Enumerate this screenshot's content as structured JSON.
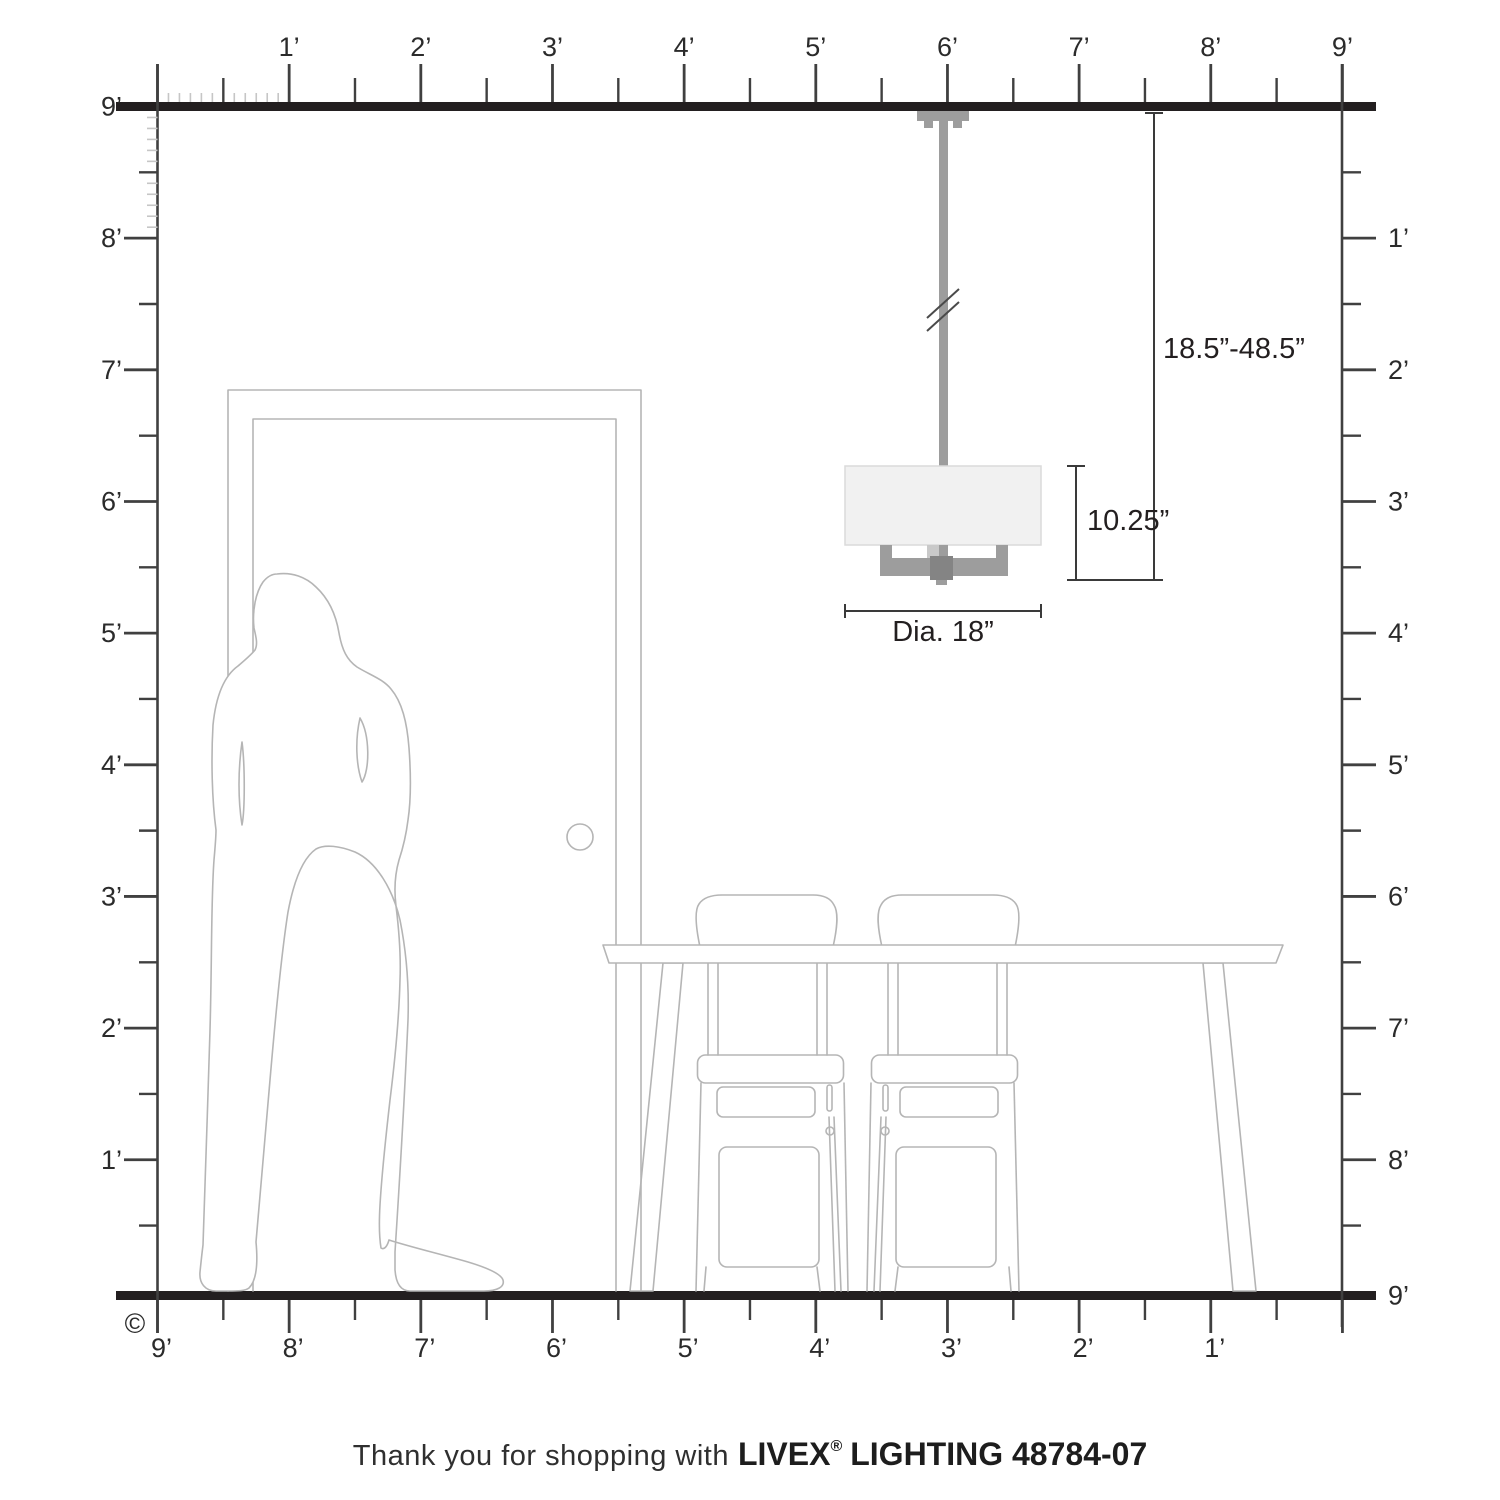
{
  "caption": {
    "prefix": "Thank you for shopping with",
    "brand": "LIVEX",
    "registered": "®",
    "suffix": "LIGHTING 48784-07"
  },
  "dimensions": {
    "drop_range": "18.5”-48.5”",
    "fixture_height": "10.25”",
    "diameter": "Dia. 18”"
  },
  "rulers": {
    "top": [
      "1’",
      "2’",
      "3’",
      "4’",
      "5’",
      "6’",
      "7’",
      "8’",
      "9’"
    ],
    "left": [
      "9’",
      "8’",
      "7’",
      "6’",
      "5’",
      "4’",
      "3’",
      "2’",
      "1’"
    ],
    "right": [
      "1’",
      "2’",
      "3’",
      "4’",
      "5’",
      "6’",
      "7’",
      "8’",
      "9’"
    ],
    "bottom": [
      "9’",
      "8’",
      "7’",
      "6’",
      "5’",
      "4’",
      "3’",
      "2’",
      "1’"
    ]
  },
  "copyright": "©",
  "colors": {
    "structure_black": "#231f20",
    "ruler_gray": "#404040",
    "inch_tick_gray": "#c6c6c6",
    "furniture_outline": "#b5b5b5",
    "fixture_gray": "#9d9d9d",
    "fixture_dark_gray": "#848484",
    "fixture_light_gray": "#c9c9c9",
    "shade_fill": "#f1f1f1",
    "shade_stroke": "#dadada"
  }
}
